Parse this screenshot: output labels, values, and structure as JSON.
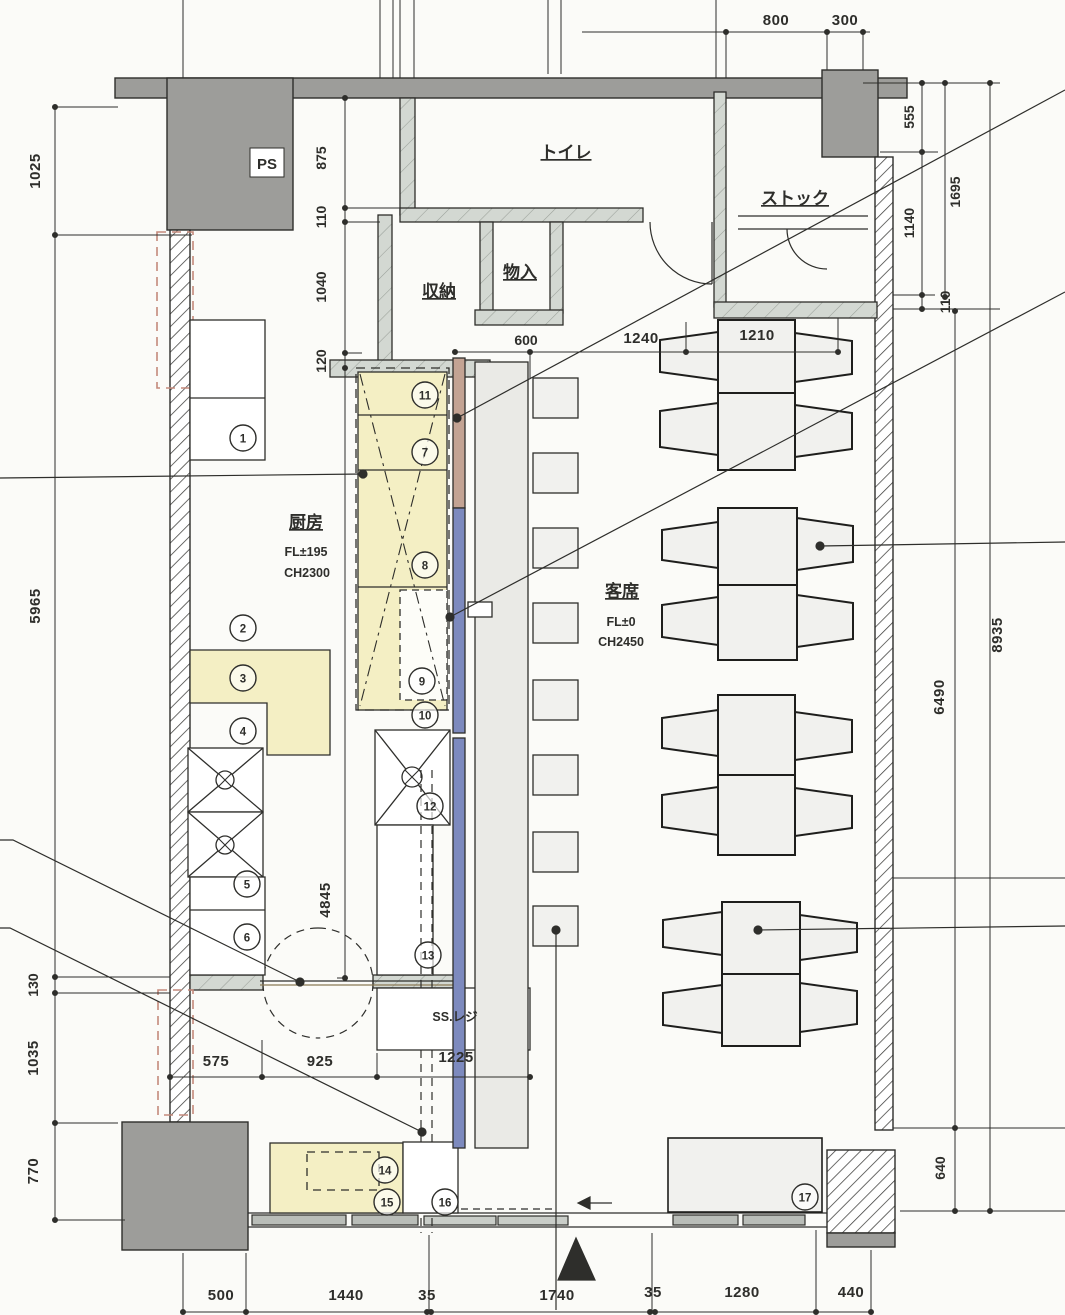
{
  "drawing": {
    "type": "restaurant-floor-plan",
    "colors": {
      "wall_gray": "#9d9d9a",
      "sill_gray": "#d3d8d2",
      "equipment_yellow": "#f4efc4",
      "counter_blue": "#7d8abe",
      "counter_tan": "#c3a393",
      "red_dash": "#c4897b",
      "furniture_fill": "#f1f1ee",
      "line": "#2e2e2b",
      "paper": "#fbfbf8"
    }
  },
  "rooms": {
    "ps": "PS",
    "toilet": "トイレ",
    "stock": "ストック",
    "storage": "収納",
    "closet": "物入",
    "kitchen": "厨房",
    "kitchen_fl": "FL±195",
    "kitchen_ch": "CH2300",
    "seating": "客席",
    "seating_fl": "FL±0",
    "seating_ch": "CH2450",
    "register": "SS.レジ"
  },
  "dims": {
    "top": [
      "800",
      "300"
    ],
    "left": [
      "1025",
      "5965",
      "130",
      "1035",
      "770"
    ],
    "kitchen_col": [
      "875",
      "110",
      "1040",
      "120",
      "4845"
    ],
    "right": [
      "555",
      "1140",
      "110",
      "1695",
      "6490",
      "8935",
      "640"
    ],
    "seating_top": [
      "600",
      "1240",
      "1210"
    ],
    "mid": [
      "575",
      "925",
      "1225"
    ],
    "bottom": [
      "500",
      "1440",
      "35",
      "1740",
      "35",
      "1280",
      "440"
    ]
  },
  "numbers": [
    "1",
    "2",
    "3",
    "4",
    "5",
    "6",
    "7",
    "8",
    "9",
    "10",
    "11",
    "12",
    "13",
    "14",
    "15",
    "16",
    "17"
  ]
}
